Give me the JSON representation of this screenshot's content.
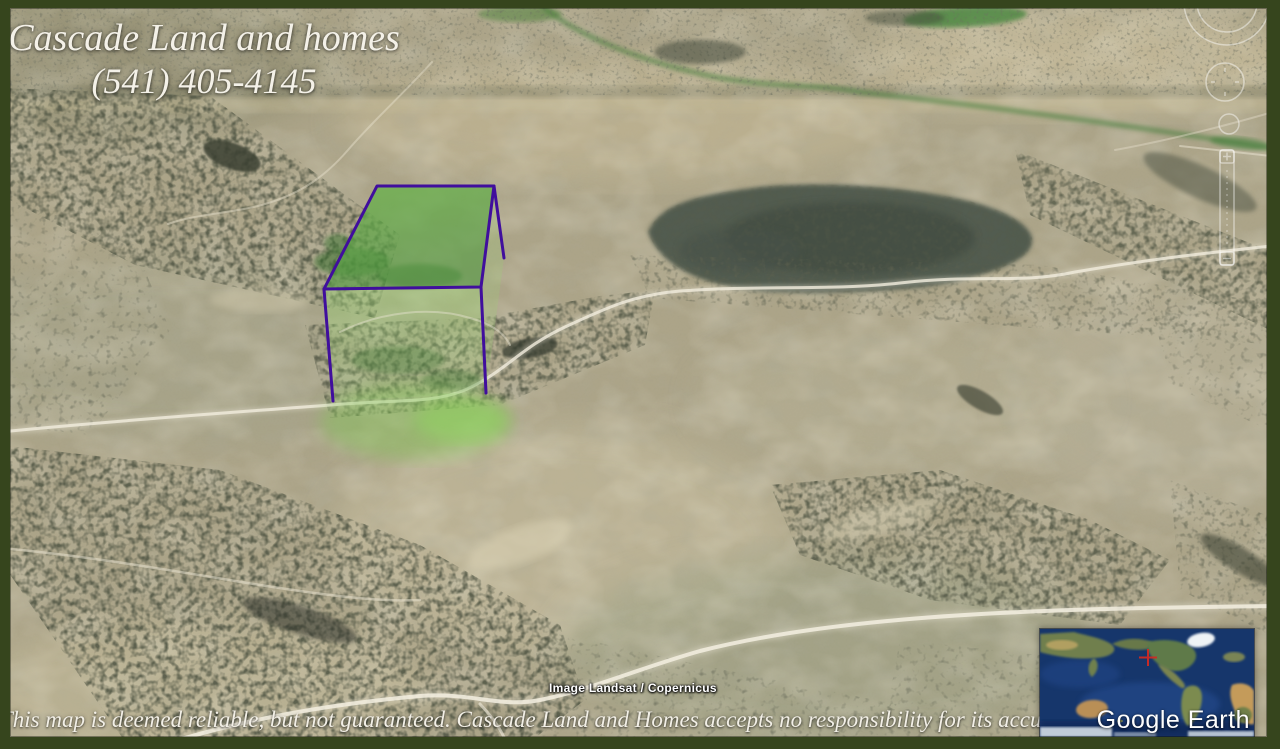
{
  "branding": {
    "company": "Cascade Land and homes",
    "phone": "(541) 405-4145"
  },
  "footer": {
    "disclaimer": "This map is deemed reliable, but not guaranteed. Cascade Land and Homes accepts no responsibility for its accuracy."
  },
  "map": {
    "attribution": "Image Landsat / Copernicus",
    "logo": "Google Earth"
  },
  "parcel": {
    "fill": "#5aa83e",
    "face_fill": "#8ed167",
    "outline": "#400e9d"
  },
  "inset": {
    "marker_icon": "red-crosshair",
    "marker_color": "#cf2a24"
  },
  "frame": {
    "border_color": "#36451d"
  }
}
